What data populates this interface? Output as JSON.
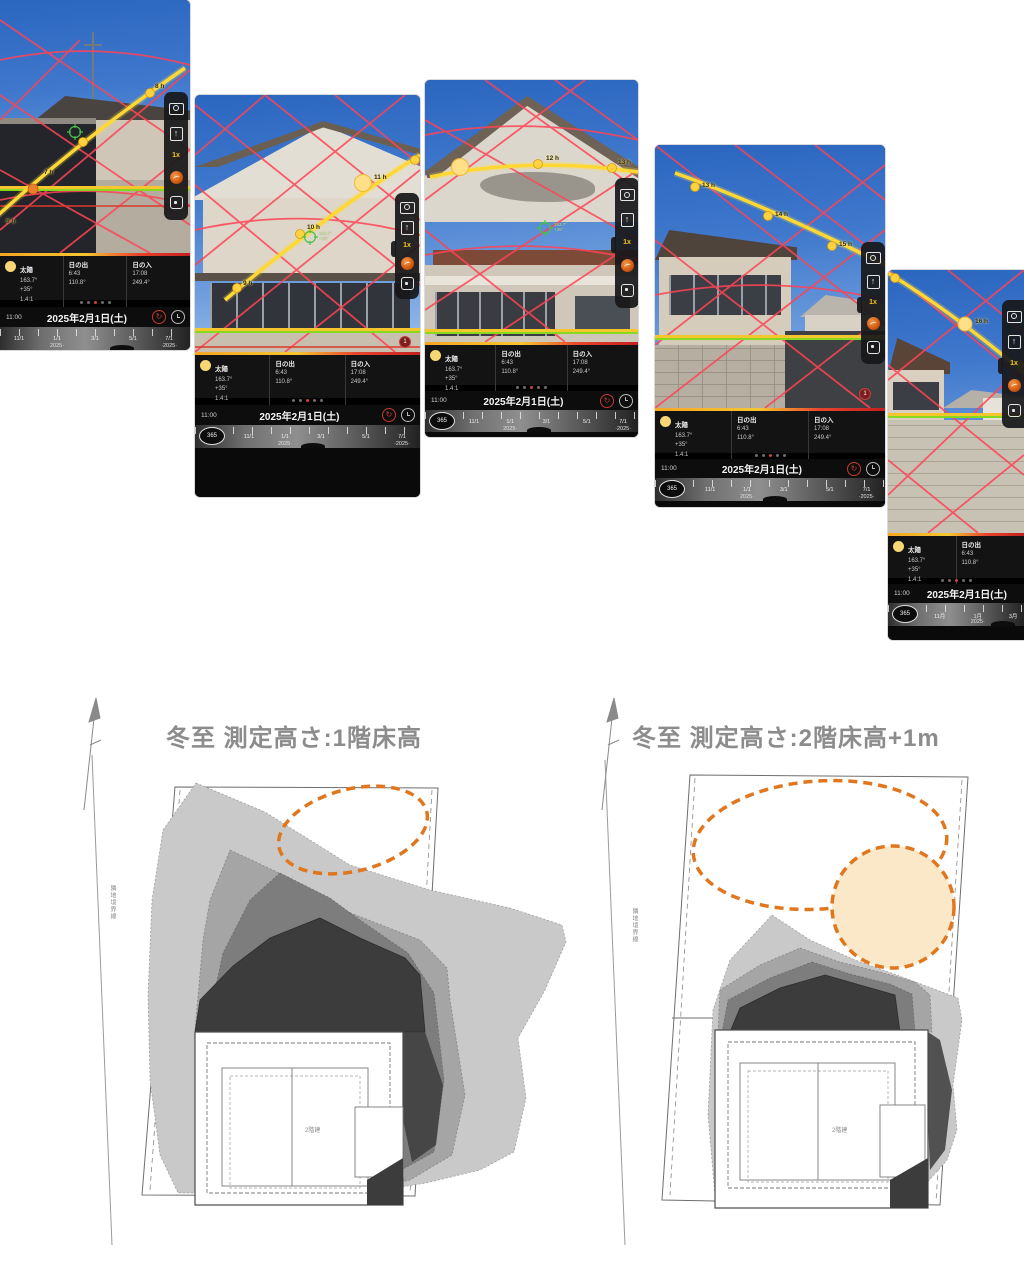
{
  "app": {
    "zoom": "1x",
    "badge": "1",
    "cross1": "163.7°",
    "cross2": "+35°",
    "panel": {
      "sun_label": "太陽",
      "sun_az": "163.7°",
      "sun_alt": "+35°",
      "sun_ratio": "1.4:1",
      "sunrise_label": "日の出",
      "sunrise_time": "6:43",
      "sunrise_az": "110.8°",
      "sunset_label": "日の入",
      "sunset_time": "17:08",
      "sunset_az": "249.4°",
      "time": "11:00",
      "date": "2025年2月1日(土)",
      "mode": "365"
    },
    "days": [
      "11/1",
      "1/1",
      "3/1",
      "5/1",
      "7/1"
    ],
    "months": [
      "11月",
      "1月",
      "3月"
    ],
    "year_start": "2025·",
    "year_end": "·2025·",
    "hours": {
      "a": [
        "6 h",
        "7 h",
        "8 h"
      ],
      "b": [
        "9 h",
        "10 h",
        "11 h"
      ],
      "c": [
        "12 h",
        "13 h"
      ],
      "d": [
        "13 h",
        "14 h",
        "15 h"
      ],
      "e": [
        "16 h"
      ]
    }
  },
  "diagrams": {
    "left": {
      "title": "冬至  測定高さ:1階床高",
      "boundary": "隣地境界線",
      "house": "2階建"
    },
    "right": {
      "title": "冬至  測定高さ:2階床高+1m",
      "boundary": "隣地境界線",
      "house": "2階建"
    }
  }
}
